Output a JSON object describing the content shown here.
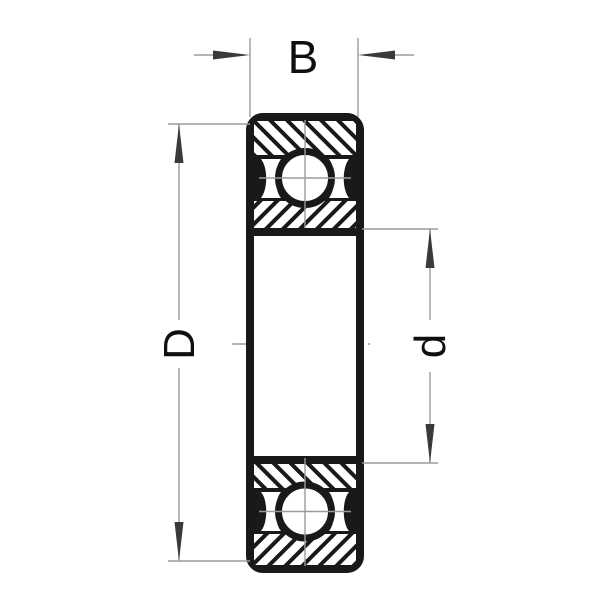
{
  "labels": {
    "width": "B",
    "outer_diameter": "D",
    "bore_diameter": "d"
  },
  "colors": {
    "line": "#191919",
    "dimension_line": "#9b9b9b",
    "arrow": "#3a3a3a",
    "label_text": "#0f0f0f",
    "background": "#ffffff"
  }
}
